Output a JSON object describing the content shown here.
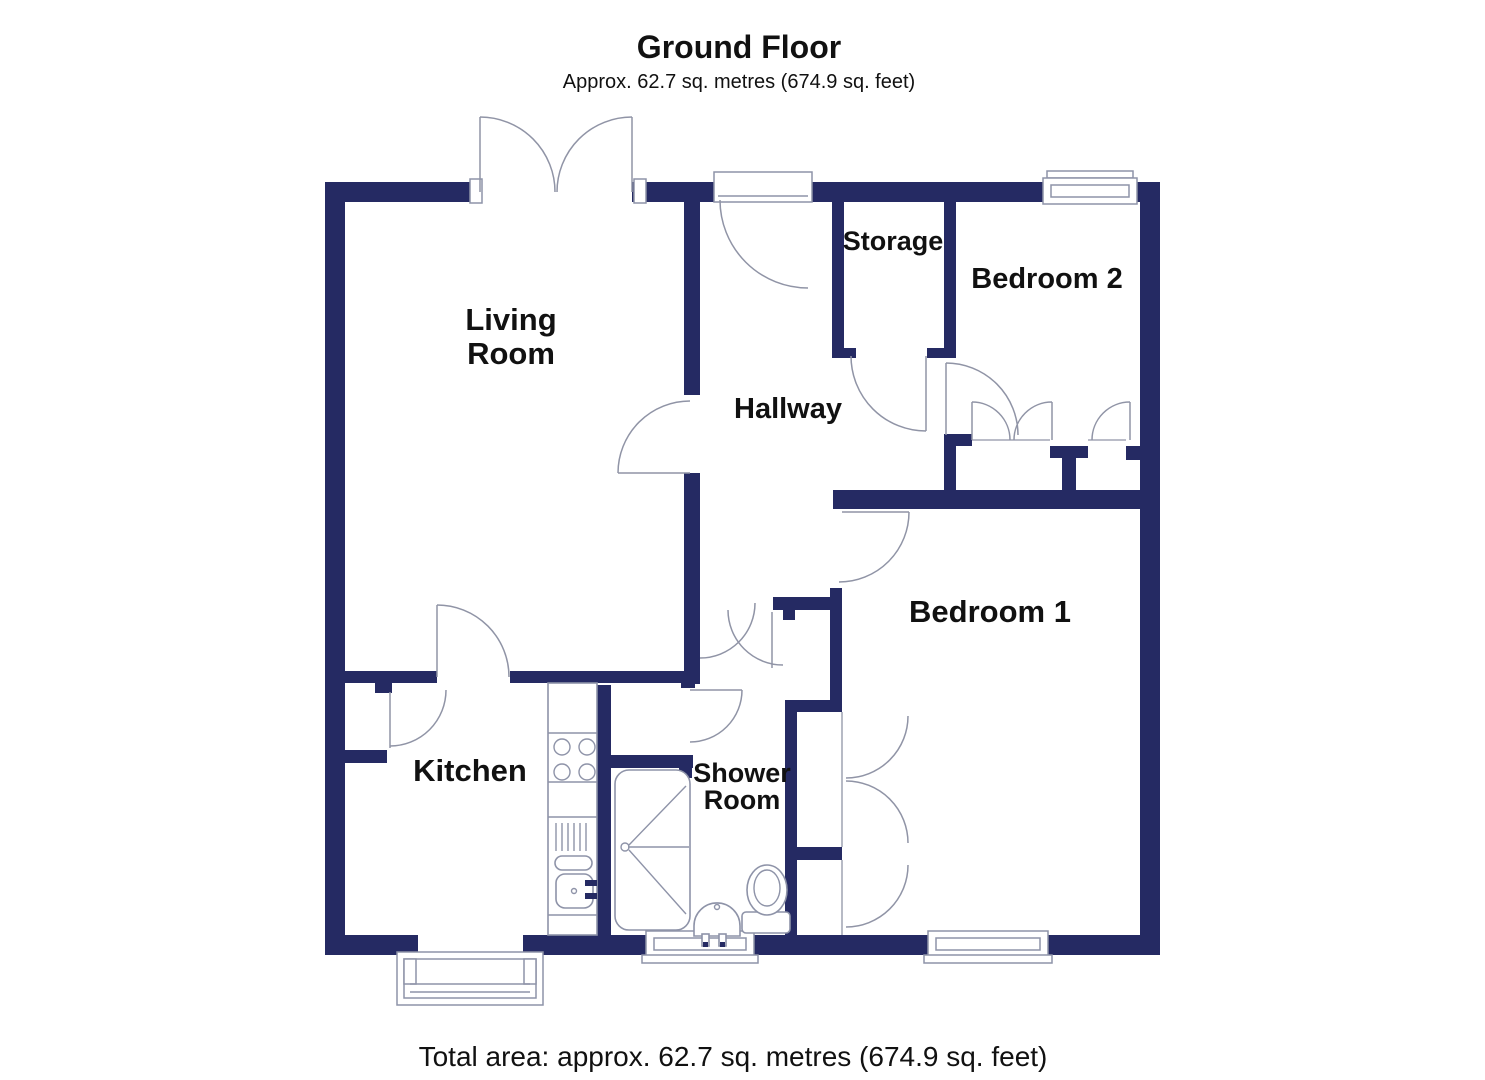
{
  "header": {
    "title": "Ground Floor",
    "subtitle": "Approx. 62.7 sq. metres (674.9 sq. feet)"
  },
  "rooms": {
    "living_room": {
      "line1": "Living",
      "line2": "Room"
    },
    "hallway": {
      "label": "Hallway"
    },
    "storage": {
      "label": "Storage"
    },
    "bedroom2": {
      "label": "Bedroom 2"
    },
    "bedroom1": {
      "label": "Bedroom 1"
    },
    "kitchen": {
      "label": "Kitchen"
    },
    "shower_room": {
      "line1": "Shower",
      "line2": "Room"
    }
  },
  "footer": {
    "total_area": "Total area: approx. 62.7 sq. metres (674.9 sq. feet)"
  },
  "colors": {
    "wall": "#252a63",
    "door_line": "#9094a6",
    "fixture_line": "#8e93a8",
    "text": "#111111",
    "background": "#ffffff"
  }
}
